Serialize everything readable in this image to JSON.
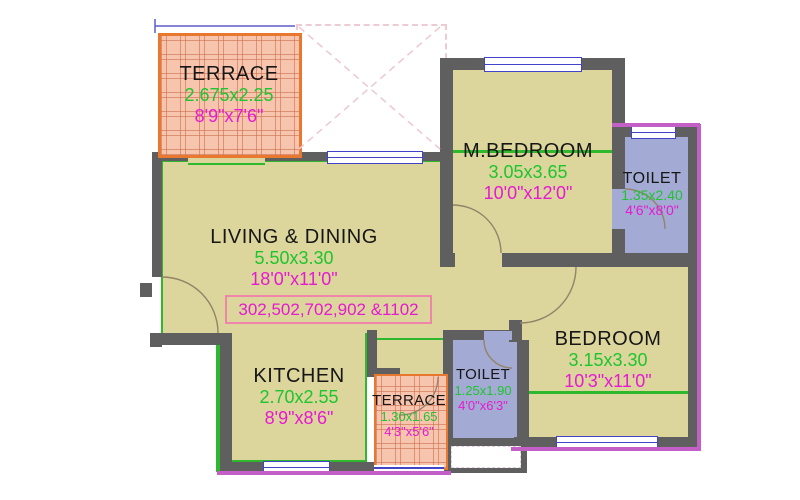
{
  "title": "apartment floor plan",
  "unit_label": "302,502,702,902 &1102",
  "rooms": [
    {
      "name": "TERRACE",
      "dim_m": "2.675x2.25",
      "dim_ft": "8'9\"x7'6\""
    },
    {
      "name": "LIVING & DINING",
      "dim_m": "5.50x3.30",
      "dim_ft": "18'0\"x11'0\""
    },
    {
      "name": "M.BEDROOM",
      "dim_m": "3.05x3.65",
      "dim_ft": "10'0\"x12'0\""
    },
    {
      "name": "TOILET",
      "dim_m": "1.35x2.40",
      "dim_ft": "4'6\"x8'0\""
    },
    {
      "name": "BEDROOM",
      "dim_m": "3.15x3.30",
      "dim_ft": "10'3\"x11'0\""
    },
    {
      "name": "TOILET",
      "dim_m": "1.25x1.90",
      "dim_ft": "4'0\"x6'3\""
    },
    {
      "name": "KITCHEN",
      "dim_m": "2.70x2.55",
      "dim_ft": "8'9\"x8'6\""
    },
    {
      "name": "TERRACE",
      "dim_m": "1.30x1.65",
      "dim_ft": "4'3\"x5'6\""
    }
  ],
  "palette": {
    "room_fill": "#dcd59c",
    "toilet_fill": "#a3aad3",
    "terrace_fill": "#f7c5ad",
    "terrace_border": "#e8772f",
    "wall": "#5f5f5f",
    "inner_line_green": "#2db82d",
    "dim_text_green": "#1ec52d",
    "dim_text_magenta": "#e61ad2",
    "outer_line_magenta": "#c45fc8",
    "window_blue": "#4343c8",
    "room_name_text": "#161616"
  }
}
